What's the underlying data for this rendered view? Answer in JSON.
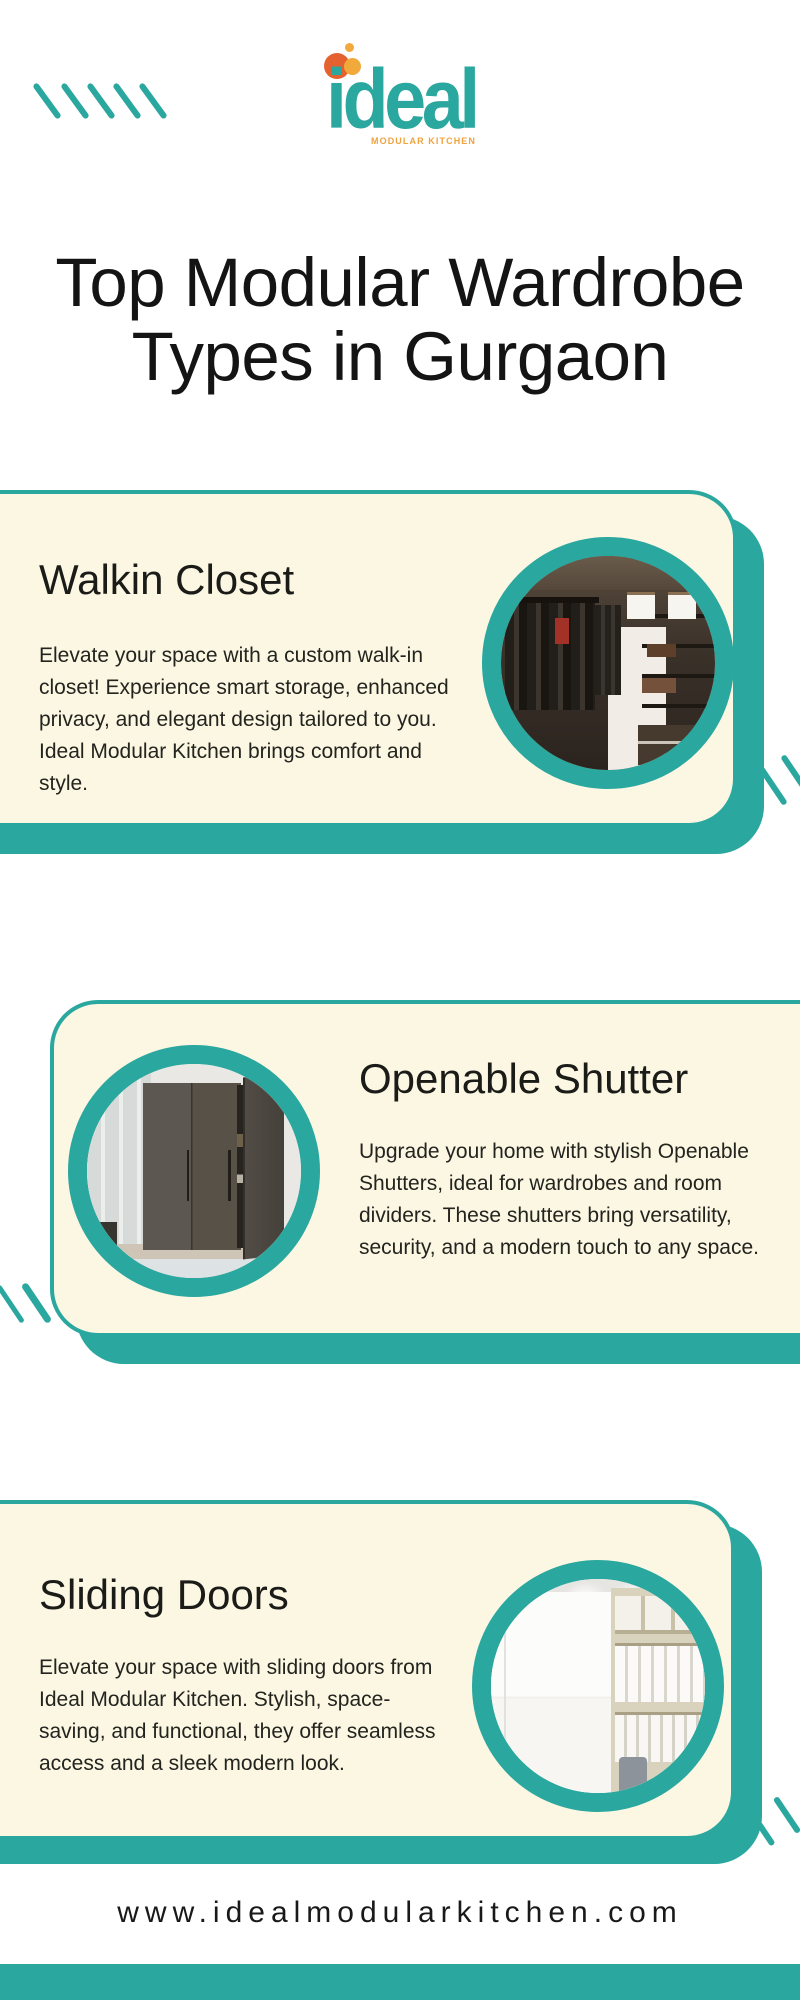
{
  "brand": {
    "logo_text": "ideal",
    "logo_tagline": "MODULAR KITCHEN"
  },
  "header": {
    "title_line1": "Top Modular Wardrobe",
    "title_line2": "Types in Gurgaon"
  },
  "cards": [
    {
      "heading": "Walkin Closet",
      "body": "Elevate your space with a custom walk-in closet! Experience smart storage, enhanced privacy, and elegant design tailored to you. Ideal Modular Kitchen brings comfort and style.",
      "image": "walk-in-closet-photo"
    },
    {
      "heading": "Openable Shutter",
      "body": "Upgrade your home with stylish Openable Shutters, ideal for wardrobes and room dividers. These shutters bring versatility, security, and a modern touch to any space.",
      "image": "openable-shutter-wardrobe-photo"
    },
    {
      "heading": "Sliding Doors",
      "body": "Elevate your space with sliding doors from Ideal Modular Kitchen. Stylish, space-saving, and functional, they offer seamless access and a sleek modern look.",
      "image": "sliding-door-wardrobe-photo"
    }
  ],
  "footer": {
    "website": "www.idealmodularkitchen.com"
  },
  "colors": {
    "accent_teal": "#2AA79E",
    "card_cream": "#FBF7E3",
    "logo_orange": "#F2A93B",
    "logo_deep_orange": "#E4622F",
    "title_black": "#141414"
  }
}
